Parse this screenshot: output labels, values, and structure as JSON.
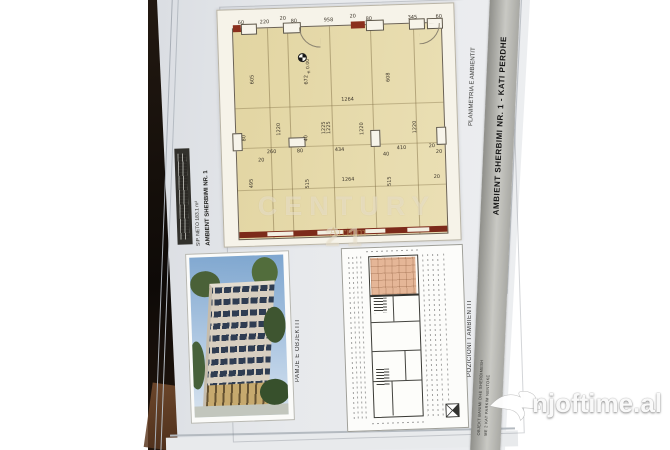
{
  "watermarks": {
    "site": "njoftime.al",
    "agency": "CENTURY 21",
    "agency_sub": "Atrium"
  },
  "titleblock": {
    "banner_title": "AMBIENT SHERBIMI NR. 1 - KATI PERDHE",
    "plan_label": "PLANIMETRIA E AMBIENTIT",
    "photo_caption": "PAMJE E OBJEKTIT",
    "keyplan_caption": "POZICIONI I AMBIENTIT",
    "project_line1": "OBJEKT BANIMI DHE SHERBIMESH",
    "project_line2": "ME 2 KAT PARKIM NENTOKE"
  },
  "unit": {
    "name": "AMBIENT SHERBIMI NR. 1",
    "area": "SIP. NETO  183.1 m²",
    "level": "±0.00"
  },
  "dims": {
    "top": [
      "60",
      "220",
      "20",
      "80",
      "958",
      "20",
      "80",
      "345",
      "60"
    ],
    "upper_heights": [
      "605",
      "672",
      "608"
    ],
    "width_upper": "1264",
    "mid_heights": [
      "1220",
      "1225",
      "1225",
      "1220",
      "1220"
    ],
    "mid": [
      "20",
      "260",
      "80",
      "434",
      "40",
      "410",
      "20",
      "20"
    ],
    "col": [
      "80",
      "40"
    ],
    "lower": [
      "495",
      "515",
      "1264",
      "515",
      "20"
    ]
  }
}
